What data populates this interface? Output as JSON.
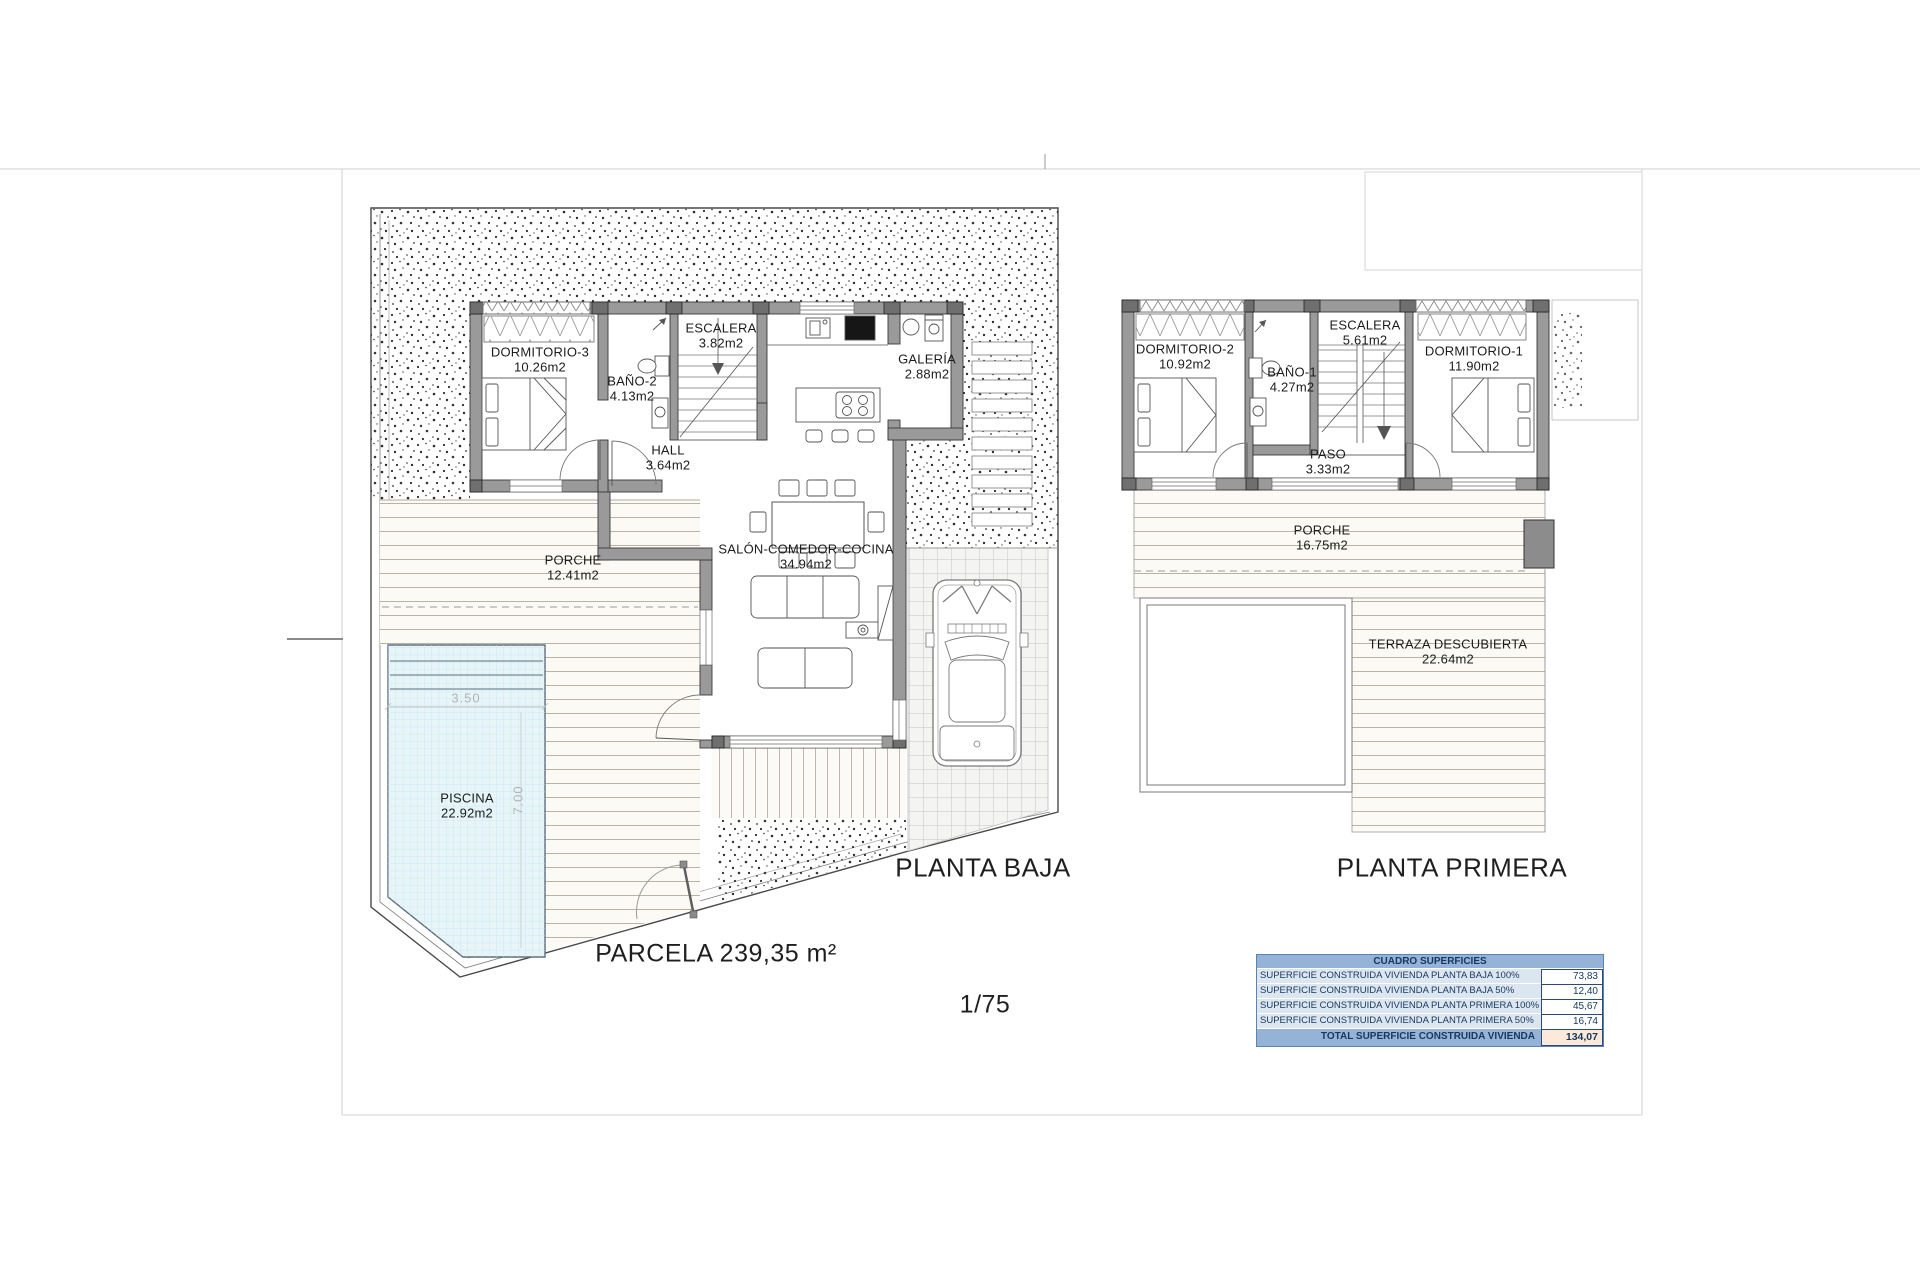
{
  "sheet": {
    "parcel_label": "PARCELA 239,35 m²",
    "scale_label": "1/75"
  },
  "plans": {
    "planta_baja": {
      "title": "PLANTA BAJA",
      "rooms": [
        {
          "name": "DORMITORIO-3",
          "area": "10.26m2"
        },
        {
          "name": "BAÑO-2",
          "area": "4.13m2"
        },
        {
          "name": "ESCALERA",
          "area": "3.82m2"
        },
        {
          "name": "GALERÍA",
          "area": "2.88m2"
        },
        {
          "name": "HALL",
          "area": "3.64m2"
        },
        {
          "name": "SALÓN-COMEDOR-COCINA",
          "area": "34.94m2"
        },
        {
          "name": "PORCHE",
          "area": "12.41m2"
        },
        {
          "name": "PISCINA",
          "area": "22.92m2"
        }
      ],
      "pool_dims": {
        "width": "3.50",
        "length": "7.00"
      }
    },
    "planta_primera": {
      "title": "PLANTA PRIMERA",
      "rooms": [
        {
          "name": "DORMITORIO-2",
          "area": "10.92m2"
        },
        {
          "name": "BAÑO-1",
          "area": "4.27m2"
        },
        {
          "name": "ESCALERA",
          "area": "5.61m2"
        },
        {
          "name": "DORMITORIO-1",
          "area": "11.90m2"
        },
        {
          "name": "PASO",
          "area": "3.33m2"
        },
        {
          "name": "PORCHE",
          "area": "16.75m2"
        },
        {
          "name": "TERRAZA DESCUBIERTA",
          "area": "22.64m2"
        }
      ]
    }
  },
  "areas_table": {
    "title": "CUADRO SUPERFICIES",
    "rows": [
      {
        "label": "SUPERFICIE CONSTRUIDA VIVIENDA PLANTA BAJA 100%",
        "value": "73,83"
      },
      {
        "label": "SUPERFICIE CONSTRUIDA VIVIENDA PLANTA BAJA 50%",
        "value": "12,40"
      },
      {
        "label": "SUPERFICIE CONSTRUIDA VIVIENDA PLANTA PRIMERA 100%",
        "value": "45,67"
      },
      {
        "label": "SUPERFICIE CONSTRUIDA VIVIENDA PLANTA PRIMERA 50%",
        "value": "16,74"
      }
    ],
    "total": {
      "label": "TOTAL SUPERFICIE CONSTRUIDA VIVIENDA",
      "value": "134,07"
    },
    "colors": {
      "header_bg": "#95b3d7",
      "row_bg": "#dce6f1",
      "total_value_bg": "#fde9d9",
      "text": "#17375e"
    }
  }
}
